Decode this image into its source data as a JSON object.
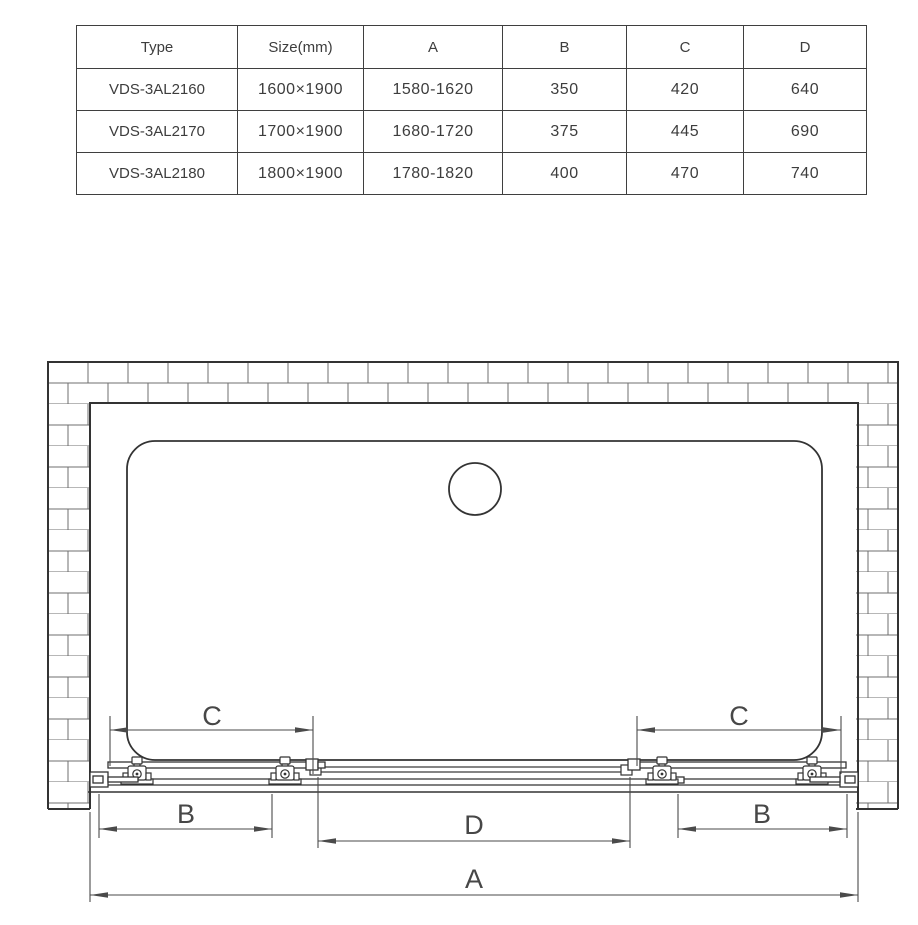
{
  "table": {
    "headers": [
      "Type",
      "Size(mm)",
      "A",
      "B",
      "C",
      "D"
    ],
    "rows": [
      [
        "VDS-3AL2160",
        "1600×1900",
        "1580-1620",
        "350",
        "420",
        "640"
      ],
      [
        "VDS-3AL2170",
        "1700×1900",
        "1680-1720",
        "375",
        "445",
        "690"
      ],
      [
        "VDS-3AL2180",
        "1800×1900",
        "1780-1820",
        "400",
        "470",
        "740"
      ]
    ]
  },
  "diagram": {
    "labels": {
      "a": "A",
      "b_left": "B",
      "b_right": "B",
      "c_left": "C",
      "c_right": "C",
      "d": "D"
    },
    "colors": {
      "line": "#333333",
      "dimension": "#4a4a4a",
      "brick": "#6f6f6f",
      "background": "#ffffff"
    }
  }
}
